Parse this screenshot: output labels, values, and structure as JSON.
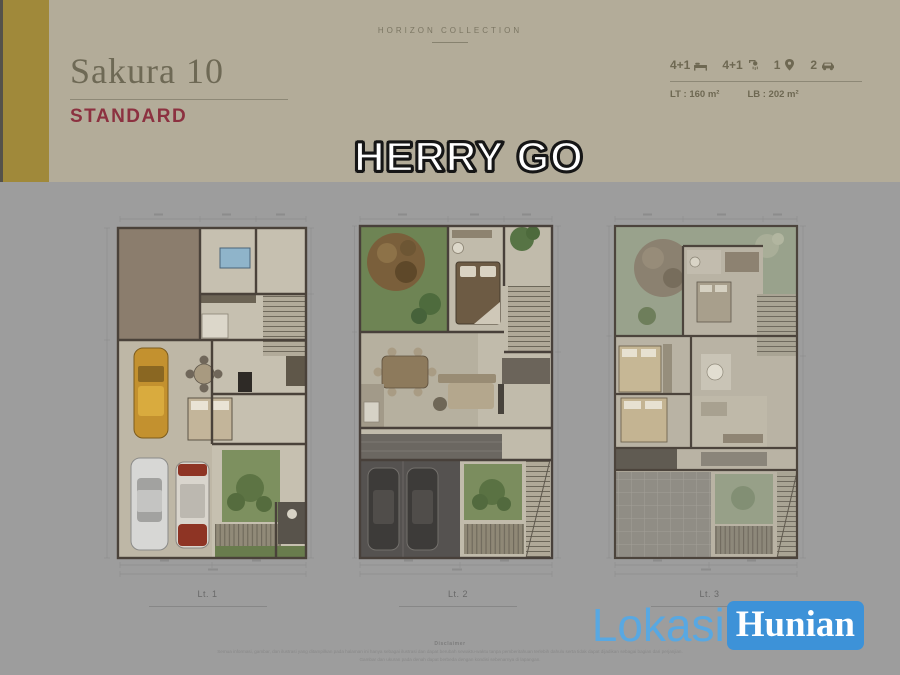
{
  "header": {
    "collection_label": "HORIZON COLLECTION",
    "title": "Sakura 10",
    "subtitle": "STANDARD",
    "specs": [
      {
        "name": "bedrooms",
        "icon": "bed-icon",
        "value": "4+1"
      },
      {
        "name": "bathrooms",
        "icon": "shower-icon",
        "value": "4+1"
      },
      {
        "name": "prayer-room",
        "icon": "pin-icon",
        "value": "1"
      },
      {
        "name": "carport",
        "icon": "car-icon",
        "value": "2"
      }
    ],
    "land_area_label": "LT : 160 m²",
    "building_area_label": "LB : 202 m²"
  },
  "overlay": {
    "watermark_name": "HERRY GO"
  },
  "plans": [
    {
      "label": "Lt. 1"
    },
    {
      "label": "Lt. 2"
    },
    {
      "label": "Lt. 3"
    }
  ],
  "footer": {
    "disclaimer_title": "Disclaimer",
    "disclaimer_line1": "Semua informasi, gambar, dan ilustrasi yang ditampilkan pada halaman ini hanya sebagai ilustrasi dan dapat berubah sewaktu-waktu tanpa pemberitahuan terlebih dahulu serta tidak dapat dijadikan sebagai bagian dari perjanjian.",
    "disclaimer_line2": "Gambar dan ukuran pada denah dapat berbeda dengan kondisi sebenarnya di lapangan."
  },
  "brand": {
    "name_part1": "Lokasi",
    "name_part2": "Hunian"
  },
  "colors": {
    "gold_bar": "#a0893a",
    "header_beige": "#b3ac99",
    "subtitle_red": "#8c3140",
    "background_gray": "#9d9d9d",
    "brand_blue": "#4aa0e0",
    "plan_paper": "#c6c0b0",
    "garden_green": "#6e8454",
    "roof_brown": "#8b7d6d"
  }
}
